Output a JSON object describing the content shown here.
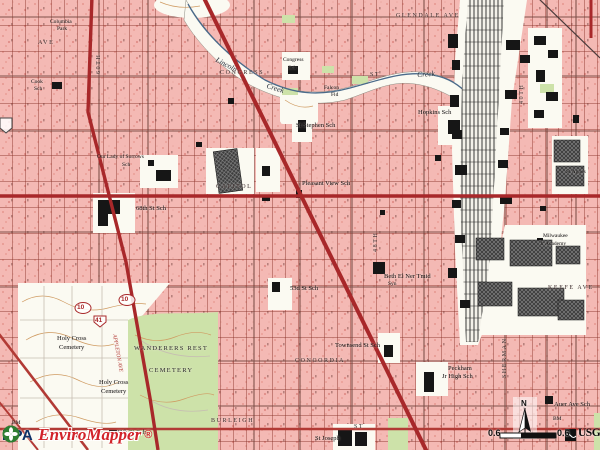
{
  "app": {
    "name": "EPA EnviroMapper map view"
  },
  "watermark": {
    "agency": "EPA",
    "product": "EnviroMapper",
    "registered": "®"
  },
  "scalebar": {
    "left_value": "0.6",
    "right_value": "0.6",
    "brand": "USGS"
  },
  "compass": {
    "north_label": "N"
  },
  "colors": {
    "pink": "#f4b9b4",
    "white_land": "#fbfaf2",
    "green_veg": "#cde2a9",
    "road_red": "#a8282a",
    "minor_red": "#b23a35",
    "rail_black": "#161616",
    "contour": "#cf9b62",
    "creek_blue": "#4a6a8a",
    "epa_blue": "#0c2f66",
    "epa_red": "#d2232a"
  },
  "map": {
    "labels": [
      {
        "text": "Columbia",
        "cls": "feat tiny",
        "x": 50,
        "y": 20
      },
      {
        "text": "Park",
        "cls": "feat tiny",
        "x": 57,
        "y": 27
      },
      {
        "text": "AVE",
        "cls": "street",
        "x": 38,
        "y": 40
      },
      {
        "text": "Cook",
        "cls": "feat tiny",
        "x": 31,
        "y": 80
      },
      {
        "text": "Sch",
        "cls": "feat tiny",
        "x": 34,
        "y": 87
      },
      {
        "text": "60TH",
        "cls": "street",
        "x": 96,
        "y": 74,
        "rot": -90
      },
      {
        "text": "Lincoln",
        "cls": "ital",
        "x": 218,
        "y": 56,
        "rot": 28
      },
      {
        "text": "Creek",
        "cls": "ital",
        "x": 268,
        "y": 82,
        "rot": 18
      },
      {
        "text": "CONGRESS",
        "cls": "street",
        "x": 220,
        "y": 70
      },
      {
        "text": "ST",
        "cls": "street",
        "x": 370,
        "y": 72
      },
      {
        "text": "Congress",
        "cls": "feat tiny",
        "x": 283,
        "y": 58
      },
      {
        "text": "Sch",
        "cls": "feat tiny",
        "x": 288,
        "y": 66
      },
      {
        "text": "GLENDALE AVE",
        "cls": "street",
        "x": 396,
        "y": 13
      },
      {
        "text": "Creek",
        "cls": "ital",
        "x": 417,
        "y": 71,
        "rot": -4
      },
      {
        "text": "Falcon",
        "cls": "feat tiny",
        "x": 324,
        "y": 86
      },
      {
        "text": "Fld",
        "cls": "feat tiny",
        "x": 331,
        "y": 93
      },
      {
        "text": "St Stephen Sch",
        "cls": "feat",
        "x": 296,
        "y": 123
      },
      {
        "text": "Hopkins Sch",
        "cls": "feat",
        "x": 418,
        "y": 110
      },
      {
        "text": "40TH",
        "cls": "street",
        "x": 519,
        "y": 104,
        "rot": -90
      },
      {
        "text": "St Agnes",
        "cls": "feat tiny",
        "x": 566,
        "y": 170
      },
      {
        "text": "Our Lady of Sorrows",
        "cls": "feat tiny",
        "x": 97,
        "y": 155
      },
      {
        "text": "Sch",
        "cls": "feat tiny",
        "x": 122,
        "y": 163
      },
      {
        "text": "CAPITOL",
        "cls": "street",
        "x": 216,
        "y": 184
      },
      {
        "text": "Pleasant View Sch",
        "cls": "feat",
        "x": 302,
        "y": 181
      },
      {
        "text": "68th St Sch",
        "cls": "feat",
        "x": 136,
        "y": 206
      },
      {
        "text": "Milwaukee",
        "cls": "feat tiny",
        "x": 543,
        "y": 234
      },
      {
        "text": "Jr Academy",
        "cls": "feat tiny",
        "x": 540,
        "y": 242
      },
      {
        "text": "48TH",
        "cls": "street",
        "x": 373,
        "y": 252,
        "rot": -90
      },
      {
        "text": "KEEFE AVE",
        "cls": "street",
        "x": 548,
        "y": 285
      },
      {
        "text": "Beth El Ner Tmid",
        "cls": "feat",
        "x": 384,
        "y": 274
      },
      {
        "text": "Syn",
        "cls": "feat tiny",
        "x": 388,
        "y": 282
      },
      {
        "text": "53d St Sch",
        "cls": "feat",
        "x": 290,
        "y": 286
      },
      {
        "text": "10",
        "cls": "shield",
        "x": 121,
        "y": 297
      },
      {
        "text": "10",
        "cls": "shield",
        "x": 77,
        "y": 305
      },
      {
        "text": "41",
        "cls": "shield",
        "x": 95,
        "y": 318
      },
      {
        "text": "APPLETON AVE",
        "cls": "redlbl",
        "x": 116,
        "y": 334,
        "rot": 80
      },
      {
        "text": "Holy Cross",
        "cls": "feat",
        "x": 57,
        "y": 336
      },
      {
        "text": "Cemetery",
        "cls": "feat",
        "x": 59,
        "y": 345
      },
      {
        "text": "WANDERERS  REST",
        "cls": "cem",
        "x": 134,
        "y": 346
      },
      {
        "text": "CEMETERY",
        "cls": "cem",
        "x": 149,
        "y": 368
      },
      {
        "text": "Holy Cross",
        "cls": "feat",
        "x": 99,
        "y": 380
      },
      {
        "text": "Cemetery",
        "cls": "feat",
        "x": 101,
        "y": 389
      },
      {
        "text": "Townsend St Sch",
        "cls": "feat",
        "x": 335,
        "y": 343
      },
      {
        "text": "CONCORDIA",
        "cls": "street",
        "x": 295,
        "y": 358
      },
      {
        "text": "SHERMAN",
        "cls": "street",
        "x": 502,
        "y": 378,
        "rot": -90
      },
      {
        "text": "Peckham",
        "cls": "feat",
        "x": 448,
        "y": 366
      },
      {
        "text": "Jr High Sch",
        "cls": "feat",
        "x": 442,
        "y": 374
      },
      {
        "text": "Auer Ave Sch",
        "cls": "feat",
        "x": 554,
        "y": 402
      },
      {
        "text": "BM",
        "cls": "feat tiny",
        "x": 553,
        "y": 417
      },
      {
        "text": "BURLEIGH",
        "cls": "street",
        "x": 211,
        "y": 418
      },
      {
        "text": "ST",
        "cls": "street",
        "x": 354,
        "y": 424
      },
      {
        "text": "49th St Sch",
        "cls": "feat",
        "x": 116,
        "y": 430
      },
      {
        "text": "St Joseph",
        "cls": "feat",
        "x": 315,
        "y": 436
      },
      {
        "text": "BM",
        "cls": "feat tiny",
        "x": 12,
        "y": 421
      }
    ]
  }
}
